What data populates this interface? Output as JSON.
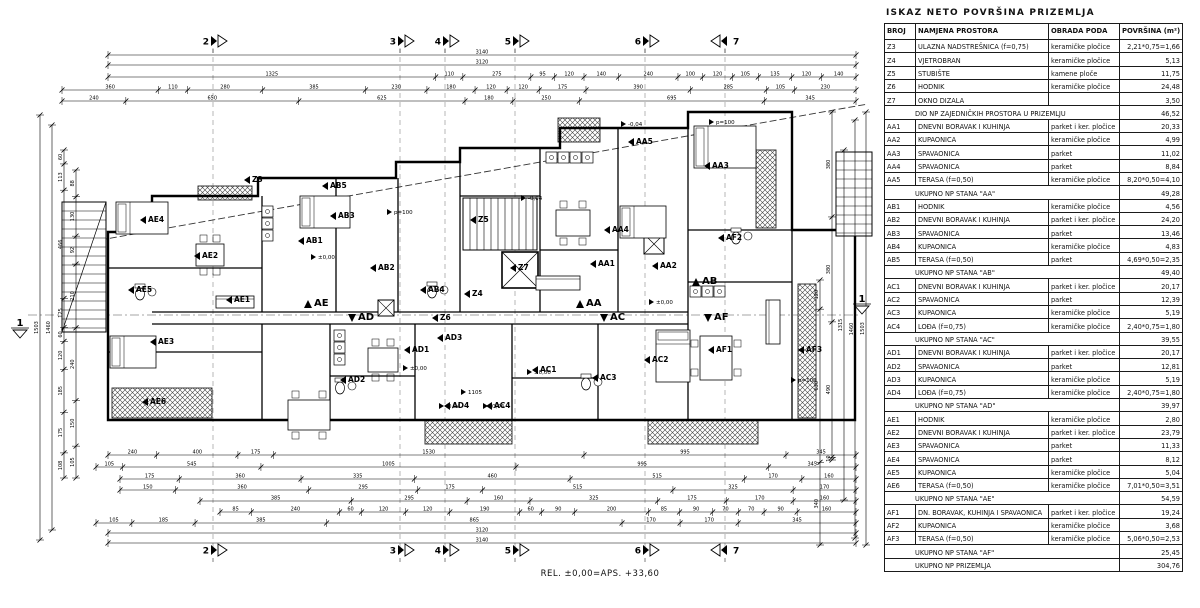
{
  "table": {
    "title": "ISKAZ NETO POVRŠINA PRIZEMLJA",
    "columns": [
      "BROJ",
      "NAMJENA PROSTORA",
      "OBRADA PODA",
      "POVRŠINA (m²)"
    ],
    "rows": [
      {
        "broj": "Z3",
        "namjena": "ULAZNA NADSTREŠNICA (f=0,75)",
        "obrada": "keramičke pločice",
        "povrsina": "2,21*0,75=1,66"
      },
      {
        "broj": "Z4",
        "namjena": "VJETROBRAN",
        "obrada": "keramičke pločice",
        "povrsina": "5,13"
      },
      {
        "broj": "Z5",
        "namjena": "STUBIŠTE",
        "obrada": "kamene ploče",
        "povrsina": "11,75"
      },
      {
        "broj": "Z6",
        "namjena": "HODNIK",
        "obrada": "keramičke pločice",
        "povrsina": "24,48"
      },
      {
        "broj": "Z7",
        "namjena": "OKNO DIZALA",
        "obrada": "",
        "povrsina": "3,50"
      },
      {
        "type": "sub",
        "label": "DIO NP ZAJEDNIČKIH PROSTORA U PRIZEMLJU",
        "povrsina": "46,52"
      },
      {
        "broj": "AA1",
        "namjena": "DNEVNI BORAVAK I KUHINJA",
        "obrada": "parket i ker. pločice",
        "povrsina": "20,33"
      },
      {
        "broj": "AA2",
        "namjena": "KUPAONICA",
        "obrada": "keramičke pločice",
        "povrsina": "4,99"
      },
      {
        "broj": "AA3",
        "namjena": "SPAVAONICA",
        "obrada": "parket",
        "povrsina": "11,02"
      },
      {
        "broj": "AA4",
        "namjena": "SPAVAONICA",
        "obrada": "parket",
        "povrsina": "8,84"
      },
      {
        "broj": "AA5",
        "namjena": "TERASA (f=0,50)",
        "obrada": "keramičke pločice",
        "povrsina": "8,20*0,50=4,10"
      },
      {
        "type": "sub",
        "label": "UKUPNO NP STANA \"AA\"",
        "povrsina": "49,28"
      },
      {
        "broj": "AB1",
        "namjena": "HODNIK",
        "obrada": "keramičke pločice",
        "povrsina": "4,56"
      },
      {
        "broj": "AB2",
        "namjena": "DNEVNI BORAVAK I KUHINJA",
        "obrada": "parket i ker. pločice",
        "povrsina": "24,20"
      },
      {
        "broj": "AB3",
        "namjena": "SPAVAONICA",
        "obrada": "parket",
        "povrsina": "13,46"
      },
      {
        "broj": "AB4",
        "namjena": "KUPAONICA",
        "obrada": "keramičke pločice",
        "povrsina": "4,83"
      },
      {
        "broj": "AB5",
        "namjena": "TERASA (f=0,50)",
        "obrada": "parket",
        "povrsina": "4,69*0,50=2,35"
      },
      {
        "type": "sub",
        "label": "UKUPNO NP STANA \"AB\"",
        "povrsina": "49,40"
      },
      {
        "broj": "AC1",
        "namjena": "DNEVNI BORAVAK I KUHINJA",
        "obrada": "parket i ker. pločice",
        "povrsina": "20,17"
      },
      {
        "broj": "AC2",
        "namjena": "SPAVAONICA",
        "obrada": "parket",
        "povrsina": "12,39"
      },
      {
        "broj": "AC3",
        "namjena": "KUPAONICA",
        "obrada": "keramičke pločice",
        "povrsina": "5,19"
      },
      {
        "broj": "AC4",
        "namjena": "LOĐA (f=0,75)",
        "obrada": "keramičke pločice",
        "povrsina": "2,40*0,75=1,80"
      },
      {
        "type": "sub",
        "label": "UKUPNO NP STANA \"AC\"",
        "povrsina": "39,55"
      },
      {
        "broj": "AD1",
        "namjena": "DNEVNI BORAVAK I KUHINJA",
        "obrada": "parket i ker. pločice",
        "povrsina": "20,17"
      },
      {
        "broj": "AD2",
        "namjena": "SPAVAONICA",
        "obrada": "parket",
        "povrsina": "12,81"
      },
      {
        "broj": "AD3",
        "namjena": "KUPAONICA",
        "obrada": "keramičke pločice",
        "povrsina": "5,19"
      },
      {
        "broj": "AD4",
        "namjena": "LOĐA (f=0,75)",
        "obrada": "keramičke pločice",
        "povrsina": "2,40*0,75=1,80"
      },
      {
        "type": "sub",
        "label": "UKUPNO NP STANA \"AD\"",
        "povrsina": "39,97"
      },
      {
        "broj": "AE1",
        "namjena": "HODNIK",
        "obrada": "keramičke pločice",
        "povrsina": "2,80"
      },
      {
        "broj": "AE2",
        "namjena": "DNEVNI BORAVAK I KUHINJA",
        "obrada": "parket i ker. pločice",
        "povrsina": "23,79"
      },
      {
        "broj": "AE3",
        "namjena": "SPAVAONICA",
        "obrada": "parket",
        "povrsina": "11,33"
      },
      {
        "broj": "AE4",
        "namjena": "SPAVAONICA",
        "obrada": "parket",
        "povrsina": "8,12"
      },
      {
        "broj": "AE5",
        "namjena": "KUPAONICA",
        "obrada": "keramičke pločice",
        "povrsina": "5,04"
      },
      {
        "broj": "AE6",
        "namjena": "TERASA (f=0,50)",
        "obrada": "keramičke pločice",
        "povrsina": "7,01*0,50=3,51"
      },
      {
        "type": "sub",
        "label": "UKUPNO NP STANA \"AE\"",
        "povrsina": "54,59"
      },
      {
        "broj": "AF1",
        "namjena": "DN. BORAVAK, KUHINJA I SPAVAONICA",
        "obrada": "parket i ker. pločice",
        "povrsina": "19,24"
      },
      {
        "broj": "AF2",
        "namjena": "KUPAONICA",
        "obrada": "keramičke pločice",
        "povrsina": "3,68"
      },
      {
        "broj": "AF3",
        "namjena": "TERASA (f=0,50)",
        "obrada": "keramičke pločice",
        "povrsina": "5,06*0,50=2,53"
      },
      {
        "type": "sub",
        "label": "UKUPNO NP STANA \"AF\"",
        "povrsina": "25,45"
      },
      {
        "type": "total",
        "label": "UKUPNO NP PRIZEMLJA",
        "povrsina": "304,76"
      }
    ]
  },
  "footer_note": "REL. ±0,00=APS. +33,60",
  "plan": {
    "section_lines_x": [
      213,
      400,
      445,
      515,
      645,
      725
    ],
    "markers_top_y": 41,
    "markers_bottom_y": 550,
    "markers_top": [
      {
        "label": "2",
        "x": 213
      },
      {
        "label": "3",
        "x": 400
      },
      {
        "label": "4",
        "x": 445
      },
      {
        "label": "5",
        "x": 515
      },
      {
        "label": "6",
        "x": 645
      },
      {
        "label": "7",
        "x": 725,
        "flip": true
      }
    ],
    "side_markers": [
      {
        "label": "1",
        "x": 20,
        "y": 330
      },
      {
        "label": "1",
        "x": 862,
        "y": 306
      }
    ],
    "cut_line": {
      "y": 315,
      "x1": 28,
      "x2": 858
    },
    "walls_outline": "108,420 108,232 152,232 152,196 258,196 258,178 396,178 396,162 460,162 460,148 560,148 560,128 688,128 688,112 792,112 792,230 855,230 855,420 108,420",
    "walls_inner": [
      "262,196 262,312",
      "262,324 262,420",
      "336,178 336,312",
      "398,178 398,312",
      "460,162 460,312",
      "540,148 540,312",
      "618,128 618,312",
      "688,128 688,420",
      "792,230 792,420",
      "330,324 330,420",
      "415,324 415,420",
      "512,324 512,420",
      "598,324 598,420",
      "108,268 262,268",
      "108,352 262,352",
      "152,312 688,312",
      "152,324 688,324",
      "688,230 792,230",
      "688,282 792,282",
      "540,250 618,250",
      "460,196 540,196",
      "330,376 415,376",
      "512,378 598,378"
    ],
    "canopy_line": {
      "x1": 100,
      "y1": 240,
      "x2": 868,
      "y2": 104
    },
    "hatches": [
      {
        "x": 198,
        "y": 186,
        "w": 54,
        "h": 14
      },
      {
        "x": 558,
        "y": 118,
        "w": 42,
        "h": 24
      },
      {
        "x": 756,
        "y": 150,
        "w": 20,
        "h": 78
      },
      {
        "x": 798,
        "y": 284,
        "w": 18,
        "h": 134
      },
      {
        "x": 112,
        "y": 388,
        "w": 100,
        "h": 30
      },
      {
        "x": 425,
        "y": 420,
        "w": 87,
        "h": 24
      },
      {
        "x": 648,
        "y": 420,
        "w": 110,
        "h": 24
      }
    ],
    "stairs": [
      {
        "x": 463,
        "y": 198,
        "w": 74,
        "h": 52,
        "dir": "v",
        "step": 7,
        "diag": false
      },
      {
        "x": 62,
        "y": 202,
        "w": 44,
        "h": 130,
        "dir": "h",
        "step": 9,
        "diag": true
      },
      {
        "x": 836,
        "y": 152,
        "w": 36,
        "h": 84,
        "dir": "h",
        "step": 9,
        "diag": false
      }
    ],
    "elevator": {
      "x": 502,
      "y": 252,
      "w": 36,
      "h": 36
    },
    "xboxes": [
      {
        "x": 378,
        "y": 300,
        "s": 16
      },
      {
        "x": 644,
        "y": 234,
        "s": 20
      }
    ],
    "furniture": {
      "beds": [
        {
          "x": 116,
          "y": 202,
          "w": 52,
          "h": 32
        },
        {
          "x": 300,
          "y": 196,
          "w": 50,
          "h": 32
        },
        {
          "x": 620,
          "y": 206,
          "w": 46,
          "h": 32
        },
        {
          "x": 694,
          "y": 126,
          "w": 62,
          "h": 42
        },
        {
          "x": 110,
          "y": 336,
          "w": 46,
          "h": 32
        },
        {
          "x": 656,
          "y": 330,
          "w": 34,
          "h": 52
        }
      ],
      "tables": [
        {
          "x": 288,
          "y": 400,
          "w": 42,
          "h": 30
        },
        {
          "x": 196,
          "y": 244,
          "w": 28,
          "h": 22
        },
        {
          "x": 556,
          "y": 210,
          "w": 34,
          "h": 26
        },
        {
          "x": 700,
          "y": 336,
          "w": 32,
          "h": 44
        },
        {
          "x": 368,
          "y": 348,
          "w": 30,
          "h": 24
        }
      ],
      "sofas": [
        {
          "x": 536,
          "y": 276,
          "w": 44,
          "h": 14
        },
        {
          "x": 216,
          "y": 296,
          "w": 38,
          "h": 12
        },
        {
          "x": 766,
          "y": 300,
          "w": 14,
          "h": 44
        }
      ],
      "wcs": [
        {
          "x": 140,
          "y": 294
        },
        {
          "x": 432,
          "y": 292
        },
        {
          "x": 736,
          "y": 238
        },
        {
          "x": 586,
          "y": 384
        },
        {
          "x": 340,
          "y": 388
        }
      ],
      "kitchens": [
        {
          "x": 262,
          "y": 206,
          "dir": "v",
          "n": 3,
          "s": 12
        },
        {
          "x": 546,
          "y": 152,
          "dir": "h",
          "n": 4,
          "s": 12
        },
        {
          "x": 690,
          "y": 286,
          "dir": "h",
          "n": 3,
          "s": 12
        },
        {
          "x": 334,
          "y": 330,
          "dir": "v",
          "n": 3,
          "s": 12
        }
      ]
    },
    "rooms": [
      {
        "l": "AE4",
        "x": 148,
        "y": 222
      },
      {
        "l": "AE2",
        "x": 202,
        "y": 258
      },
      {
        "l": "AE5",
        "x": 136,
        "y": 292
      },
      {
        "l": "AE3",
        "x": 158,
        "y": 344
      },
      {
        "l": "AE1",
        "x": 234,
        "y": 302
      },
      {
        "l": "AE6",
        "x": 150,
        "y": 404
      },
      {
        "l": "AB3",
        "x": 338,
        "y": 218
      },
      {
        "l": "AB1",
        "x": 306,
        "y": 243
      },
      {
        "l": "AB2",
        "x": 378,
        "y": 270
      },
      {
        "l": "AB4",
        "x": 428,
        "y": 292
      },
      {
        "l": "AB5",
        "x": 330,
        "y": 188
      },
      {
        "l": "Z3",
        "x": 252,
        "y": 182
      },
      {
        "l": "Z4",
        "x": 472,
        "y": 296
      },
      {
        "l": "Z5",
        "x": 478,
        "y": 222
      },
      {
        "l": "Z6",
        "x": 440,
        "y": 320
      },
      {
        "l": "Z7",
        "x": 518,
        "y": 270
      },
      {
        "l": "AA1",
        "x": 598,
        "y": 266
      },
      {
        "l": "AA4",
        "x": 612,
        "y": 232
      },
      {
        "l": "AA2",
        "x": 660,
        "y": 268
      },
      {
        "l": "AA3",
        "x": 712,
        "y": 168
      },
      {
        "l": "AA5",
        "x": 636,
        "y": 144
      },
      {
        "l": "AD1",
        "x": 412,
        "y": 352
      },
      {
        "l": "AD2",
        "x": 348,
        "y": 382
      },
      {
        "l": "AD3",
        "x": 445,
        "y": 340
      },
      {
        "l": "AD4",
        "x": 452,
        "y": 408
      },
      {
        "l": "AC1",
        "x": 540,
        "y": 372
      },
      {
        "l": "AC3",
        "x": 600,
        "y": 380
      },
      {
        "l": "AC2",
        "x": 652,
        "y": 362
      },
      {
        "l": "AC4",
        "x": 494,
        "y": 408
      },
      {
        "l": "AF1",
        "x": 716,
        "y": 352
      },
      {
        "l": "AF2",
        "x": 726,
        "y": 240
      },
      {
        "l": "AF3",
        "x": 806,
        "y": 352
      }
    ],
    "units": [
      {
        "l": "AE",
        "x": 314,
        "y": 306,
        "dir": "up"
      },
      {
        "l": "AD",
        "x": 358,
        "y": 320,
        "dir": "down"
      },
      {
        "l": "AA",
        "x": 586,
        "y": 306,
        "dir": "up"
      },
      {
        "l": "AC",
        "x": 610,
        "y": 320,
        "dir": "down"
      },
      {
        "l": "AB",
        "x": 702,
        "y": 284,
        "dir": "up"
      },
      {
        "l": "AF",
        "x": 714,
        "y": 320,
        "dir": "down"
      }
    ],
    "annotations": [
      {
        "t": "±0,00",
        "x": 318,
        "y": 257
      },
      {
        "t": "±0,00",
        "x": 410,
        "y": 368
      },
      {
        "t": "±0,00",
        "x": 534,
        "y": 372
      },
      {
        "t": "±0,00",
        "x": 656,
        "y": 302
      },
      {
        "t": "-0,04",
        "x": 446,
        "y": 406
      },
      {
        "t": "-0,04",
        "x": 490,
        "y": 406
      },
      {
        "t": "-0,04",
        "x": 628,
        "y": 124
      },
      {
        "t": "-0,04",
        "x": 528,
        "y": 198
      },
      {
        "t": "p=100",
        "x": 394,
        "y": 212
      },
      {
        "t": "p=100",
        "x": 716,
        "y": 122
      },
      {
        "t": "p=100",
        "x": 798,
        "y": 380
      },
      {
        "t": "1105",
        "x": 468,
        "y": 392
      }
    ],
    "dims": {
      "top": [
        {
          "y": 55,
          "a": 108,
          "b": 856,
          "vals": [
            "3140"
          ]
        },
        {
          "y": 65,
          "a": 108,
          "b": 856,
          "vals": [
            "3120"
          ]
        },
        {
          "y": 77,
          "a": 108,
          "b": 856,
          "vals": [
            "1325",
            "110",
            "275",
            "95",
            "120",
            "140",
            "240",
            "100",
            "120",
            "105",
            "135",
            "120",
            "140"
          ]
        },
        {
          "y": 90,
          "a": 62,
          "b": 856,
          "vals": [
            "360",
            "110",
            "280",
            "385",
            "230",
            "180",
            "120",
            "120",
            "175",
            "390",
            "285",
            "105",
            "230"
          ]
        },
        {
          "y": 101,
          "a": 62,
          "b": 856,
          "vals": [
            "240",
            "650",
            "625",
            "180",
            "250",
            "695",
            "345"
          ]
        }
      ],
      "bottom": [
        {
          "y": 455,
          "a": 108,
          "b": 856,
          "vals": [
            "240",
            "400",
            "175",
            "1530",
            "995",
            "345"
          ]
        },
        {
          "y": 467,
          "a": 96,
          "b": 856,
          "vals": [
            "105",
            "545",
            "1005",
            "995",
            "345"
          ]
        },
        {
          "y": 479,
          "a": 120,
          "b": 856,
          "vals": [
            "175",
            "360",
            "335",
            "460",
            "515",
            "170",
            "160"
          ]
        },
        {
          "y": 490,
          "a": 120,
          "b": 856,
          "vals": [
            "150",
            "360",
            "295",
            "175",
            "515",
            "325",
            "170"
          ]
        },
        {
          "y": 501,
          "a": 200,
          "b": 856,
          "vals": [
            "385",
            "295",
            "160",
            "325",
            "175",
            "170",
            "160"
          ]
        },
        {
          "y": 512,
          "a": 220,
          "b": 856,
          "vals": [
            "85",
            "240",
            "60",
            "120",
            "120",
            "190",
            "60",
            "90",
            "200",
            "85",
            "90",
            "70",
            "70",
            "90",
            "160"
          ]
        },
        {
          "y": 523,
          "a": 96,
          "b": 856,
          "vals": [
            "105",
            "185",
            "385",
            "865",
            "170",
            "170",
            "345"
          ]
        },
        {
          "y": 533,
          "a": 108,
          "b": 856,
          "vals": [
            "3120"
          ]
        },
        {
          "y": 543,
          "a": 108,
          "b": 856,
          "vals": [
            "3140"
          ]
        }
      ],
      "left": [
        {
          "x": 40,
          "a": 115,
          "b": 540,
          "vals": [
            "1503"
          ]
        },
        {
          "x": 52,
          "a": 125,
          "b": 530,
          "vals": [
            "1460"
          ]
        },
        {
          "x": 64,
          "a": 150,
          "b": 478,
          "vals": [
            "60",
            "113",
            "466",
            "125",
            "60",
            "120",
            "185",
            "175",
            "108"
          ]
        },
        {
          "x": 76,
          "a": 170,
          "b": 478,
          "vals": [
            "88",
            "130",
            "92",
            "210",
            "240",
            "150",
            "105"
          ]
        }
      ],
      "right": [
        {
          "x": 866,
          "a": 112,
          "b": 545,
          "vals": [
            "1503"
          ]
        },
        {
          "x": 855,
          "a": 120,
          "b": 538,
          "vals": [
            "1460"
          ]
        },
        {
          "x": 844,
          "a": 150,
          "b": 500,
          "vals": [
            "1315"
          ]
        },
        {
          "x": 832,
          "a": 112,
          "b": 460,
          "vals": [
            "380",
            "380",
            "490",
            "10"
          ]
        },
        {
          "x": 820,
          "a": 280,
          "b": 545,
          "vals": [
            "120",
            "630",
            "340"
          ]
        }
      ]
    }
  }
}
